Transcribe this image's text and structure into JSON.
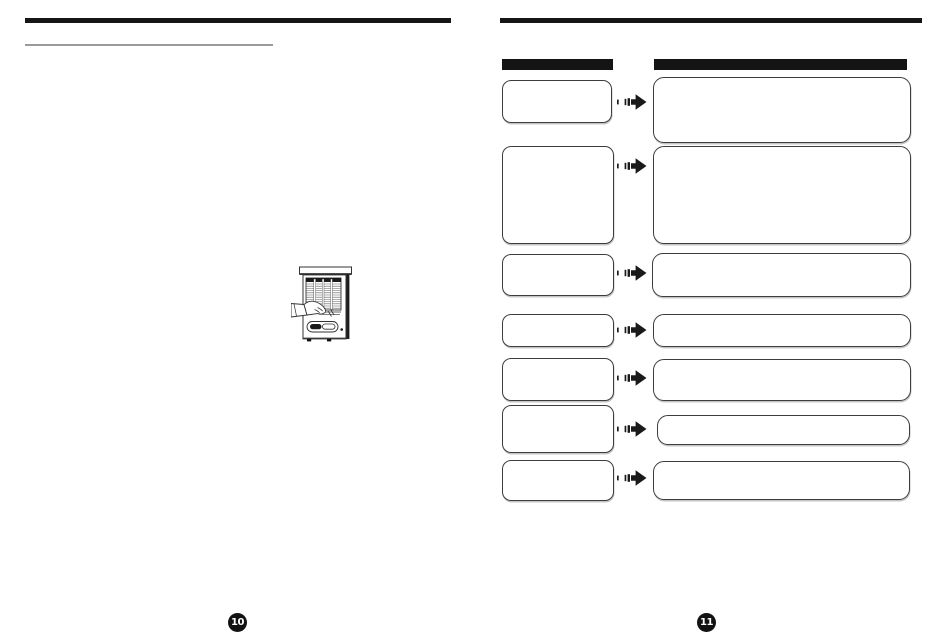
{
  "document": {
    "kind": "scanned-manual-two-page-spread",
    "note": "body text not rendered in scan; only rules, boxes, arrows, illustration and page numbers are visible"
  },
  "left_page": {
    "page_number": "10",
    "illustration": "air-conditioner-filter-removal-hand"
  },
  "right_page": {
    "page_number": "11",
    "header_bars": [
      "symptom-column-header",
      "cause-remedy-column-header"
    ],
    "row_count": 7,
    "rows": [
      {
        "left": {
          "y": 80,
          "w": 108,
          "h": 41
        },
        "arrow_cy": 102,
        "right": {
          "x": 653,
          "y": 77,
          "w": 256,
          "h": 64
        }
      },
      {
        "left": {
          "y": 146,
          "w": 110,
          "h": 96
        },
        "arrow_cy": 166,
        "right": {
          "x": 653,
          "y": 146,
          "w": 256,
          "h": 96
        }
      },
      {
        "left": {
          "y": 254,
          "w": 110,
          "h": 40
        },
        "arrow_cy": 273,
        "right": {
          "x": 652,
          "y": 253,
          "w": 257,
          "h": 42
        }
      },
      {
        "left": {
          "y": 314,
          "w": 110,
          "h": 31
        },
        "arrow_cy": 330,
        "right": {
          "x": 653,
          "y": 314,
          "w": 256,
          "h": 31
        }
      },
      {
        "left": {
          "y": 358,
          "w": 110,
          "h": 41
        },
        "arrow_cy": 378,
        "right": {
          "x": 653,
          "y": 359,
          "w": 256,
          "h": 40
        }
      },
      {
        "left": {
          "y": 405,
          "w": 110,
          "h": 46
        },
        "arrow_cy": 429,
        "right": {
          "x": 657,
          "y": 415,
          "w": 251,
          "h": 28
        }
      },
      {
        "left": {
          "y": 460,
          "w": 110,
          "h": 39
        },
        "arrow_cy": 478,
        "right": {
          "x": 653,
          "y": 461,
          "w": 255,
          "h": 37
        }
      }
    ]
  },
  "colors": {
    "page_background": "#ffffff",
    "rule_black": "#161616",
    "header_bar": "#141414",
    "box_border": "#3d3d3d",
    "underline_gray": "#9a9a9a",
    "page_circle": "#121212",
    "page_number_text": "#ffffff",
    "arrow": "#1a1a1a"
  }
}
